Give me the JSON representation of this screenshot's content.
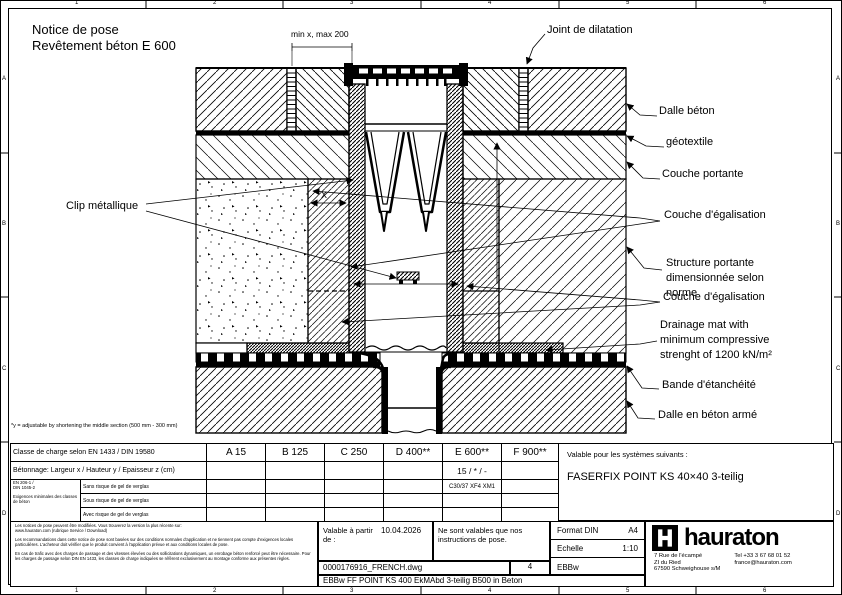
{
  "frame": {
    "cols": [
      "1",
      "2",
      "3",
      "4",
      "5",
      "6"
    ],
    "rows": [
      "A",
      "B",
      "C",
      "D"
    ]
  },
  "title": {
    "line1": "Notice de pose",
    "line2": "Revêtement béton E 600"
  },
  "drawing": {
    "dim_top": "min x, max 200",
    "dim_x": "X",
    "clip_label": "Clip métallique",
    "labels": {
      "joint": "Joint de dilatation",
      "dalle_beton": "Dalle béton",
      "geotextile": "géotextile",
      "couche_portante": "Couche portante",
      "couche_egalisation_1": "Couche d'égalisation",
      "structure_portante": "Structure portante\ndimensionnée selon\nnorme",
      "couche_egalisation_2": "Couche d'égalisation",
      "drainage_mat": "Drainage mat with\nminimum compressive\nstrenght of 1200 kN/m²",
      "bande_etancheite": "Bande d'étanchéité",
      "dalle_beton_arme": "Dalle en béton armé"
    },
    "footnote": "*y = adjustable by shortening the middle section (500 mm - 300 mm)"
  },
  "table": {
    "load_class_label": "Classe de charge selon EN 1433 / DIN 19580",
    "classes": [
      "A 15",
      "B 125",
      "C 250",
      "D 400**",
      "E 600**",
      "F 900**"
    ],
    "concrete_row_label": "Bétonnage: Largeur x / Hauteur y / Epaisseur z (cm)",
    "concrete_values": [
      "",
      "",
      "",
      "",
      "15 / * / -",
      ""
    ],
    "spec_norms": "EN 206-1 /\nDIN 1045-2",
    "spec_note": "Exigences minimales des classes de béton",
    "spec_rows": [
      {
        "label": "Sans risque de gel de verglas",
        "values": [
          "",
          "",
          "",
          "",
          "C30/37 XF4 XM1",
          ""
        ]
      },
      {
        "label": "Sous risque de gel de verglas",
        "values": [
          "",
          "",
          "",
          "",
          "",
          ""
        ]
      },
      {
        "label": "Avec risque de gel de verglas",
        "values": [
          "",
          "",
          "",
          "",
          "",
          ""
        ]
      }
    ]
  },
  "systems": {
    "label": "Valable pour les systèmes suivants :",
    "value": "FASERFIX POINT KS 40×40 3-teilig"
  },
  "titleblock": {
    "disclaimer_1": "Les notices de pose peuvent être modifiées. Vous trouverez la version la plus récente sur:\nwww.hauraton.com (rubrique Service / Download)",
    "disclaimer_2": "Les recommandations dans cette notice de pose sont basées sur des conditions normales d'application et ne tiennent pas compte d'exigences locales particulières. L'acheteur doit vérifier que le produit convient à l'application prévue et aux conditions locales de pose.",
    "disclaimer_3": "En cas de trafic avec des charges de passage et des vitesses élevées ou des sollicitations dynamiques, un enrobage béton renforcé peut être nécessaire. Pour les charges de passage selon DIN EN 1433, les classes de charge indiquées se réfèrent exclusivement au montage conforme aux présentes règles.",
    "valid_from_label": "Valable à partir de :",
    "valid_from_date": "10.04.2026",
    "note": "Ne sont valables que nos instructions de pose.",
    "file_name": "0000176916_FRENCH.dwg",
    "sheet_number": "4",
    "code": "EBBw",
    "doc_title": "EBBw FF POINT KS 400 EkMAbd 3-teilig B500 in Beton",
    "format_label": "Format DIN",
    "format_value": "A4",
    "scale_label": "Echelle",
    "scale_value": "1:10",
    "brand": "hauraton",
    "address": "7 Rue de l'écampé\nZI du Ried\n67590 Schweighouse s/M",
    "phone": "Tel +33 3 67 68 01 52",
    "email": "france@hauraton.com"
  }
}
